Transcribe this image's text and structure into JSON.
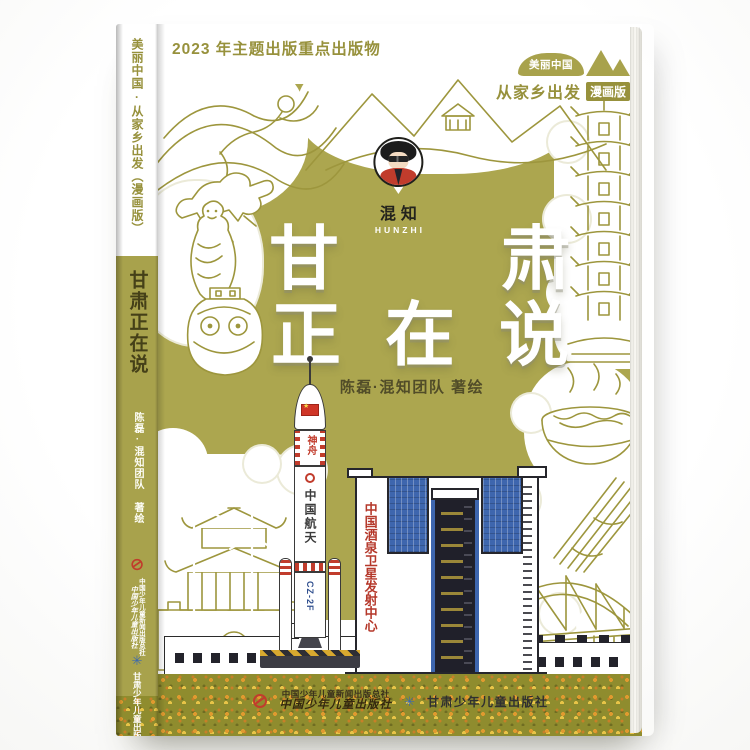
{
  "banner": {
    "text": "2023 年主题出版重点出版物"
  },
  "series_logo": {
    "brand": "美丽中国",
    "tagline": "从家乡出发",
    "badge": "漫画版"
  },
  "hunzhi_logo": {
    "cn": "混知",
    "en": "HUNZHI"
  },
  "title": {
    "char1": "甘",
    "char2": "肃",
    "line2": "正在说"
  },
  "author": "陈磊·混知团队  著绘",
  "artwork_text": {
    "rocket_band": "神舟",
    "rocket_body": "中国航天",
    "rocket_model": "CZ-2F",
    "building_sign": "中国酒泉卫星发射中心"
  },
  "icons": {
    "flag_star": "★",
    "press2_logo_glyph": "✳"
  },
  "publishers": {
    "press1_full": "中国少年儿童新闻出版总社",
    "press1_imprint": "中国少年儿童出版社",
    "press2": "甘肃少年儿童出版社"
  },
  "spine": {
    "series": "美丽中国·从家乡出发（漫画版）",
    "title": "甘肃正在说",
    "author": "陈磊·混知团队 著绘",
    "press1_full": "中国少年儿童新闻出版总社",
    "press1_imprint": "中国少年儿童出版社",
    "press2": "甘肃少年儿童出版社"
  },
  "colors": {
    "cover_olive": "#aca64f",
    "line_olive": "#9d963d",
    "accent_red": "#c13c2c",
    "building_blue": "#3e66ae",
    "spine_title": "#454018"
  }
}
